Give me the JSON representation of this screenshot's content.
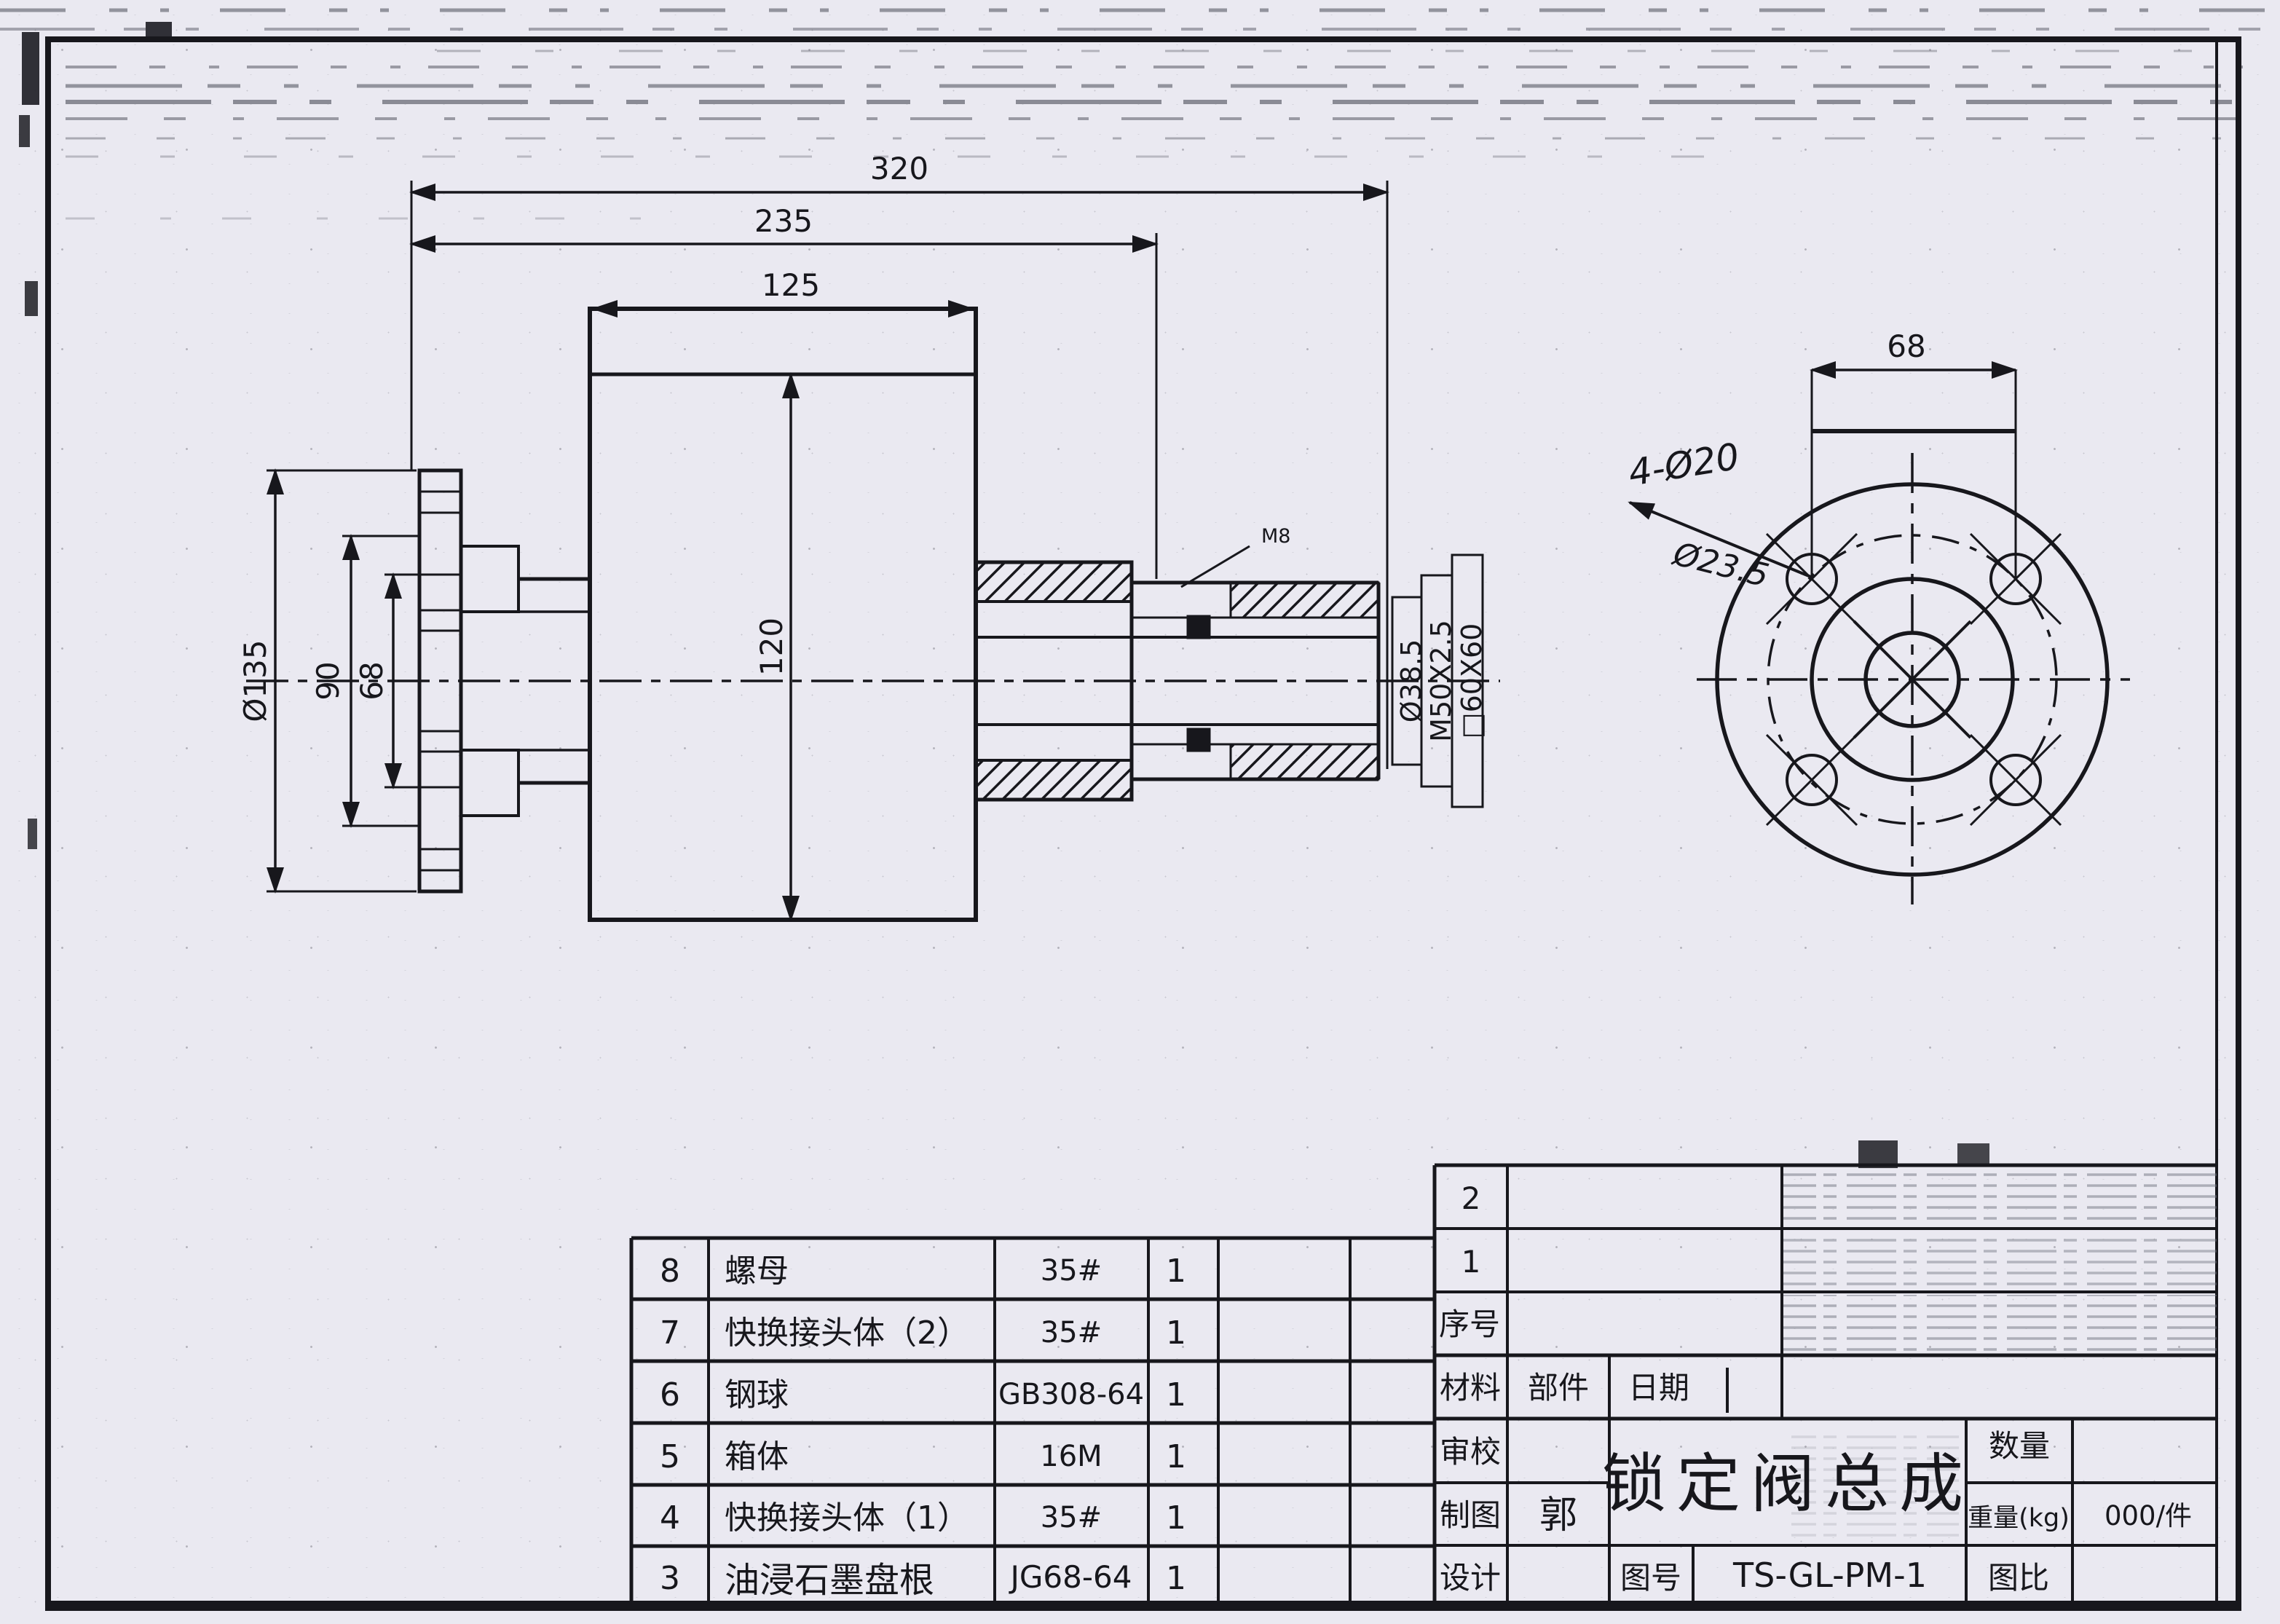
{
  "drawing": {
    "dims": {
      "overall": "320",
      "to_thread": "235",
      "body_w": "125",
      "body_h": "120",
      "flange_od": "Ø135",
      "flange_mid": "90",
      "pipe": "68",
      "bore": "Ø38.5",
      "thread": "M50X2.5",
      "square": "□60X60",
      "tap": "M8"
    },
    "end_view": {
      "hole_span": "68",
      "holes": "4-Ø20",
      "struck_note": "Ø23.5"
    }
  },
  "parts_table": {
    "rows": [
      {
        "no": "8",
        "name": "螺母",
        "spec": "35#",
        "qty": "1"
      },
      {
        "no": "7",
        "name": "快换接头体（2）",
        "spec": "35#",
        "qty": "1"
      },
      {
        "no": "6",
        "name": "钢球",
        "spec": "GB308-64",
        "qty": "1"
      },
      {
        "no": "5",
        "name": "箱体",
        "spec": "16M",
        "qty": "1"
      },
      {
        "no": "4",
        "name": "快换接头体（1）",
        "spec": "35#",
        "qty": "1"
      },
      {
        "no": "3",
        "name": "油浸石墨盘根",
        "spec": "JG68-64",
        "qty": "1"
      }
    ]
  },
  "title_block": {
    "row2": "2",
    "row1": "1",
    "seq_label": "序号",
    "material_label": "材料",
    "part_label": "部件",
    "date_label": "日期",
    "check_label": "审校",
    "draft_label": "制图",
    "draft_value": "郭",
    "design_label": "设计",
    "title": "锁定阀总成",
    "qty_label": "数量",
    "weight_label": "重量(kg)",
    "weight_value": "000/件",
    "drawing_no_label": "图号",
    "drawing_no": "TS-GL-PM-1",
    "scale_label": "图比"
  }
}
